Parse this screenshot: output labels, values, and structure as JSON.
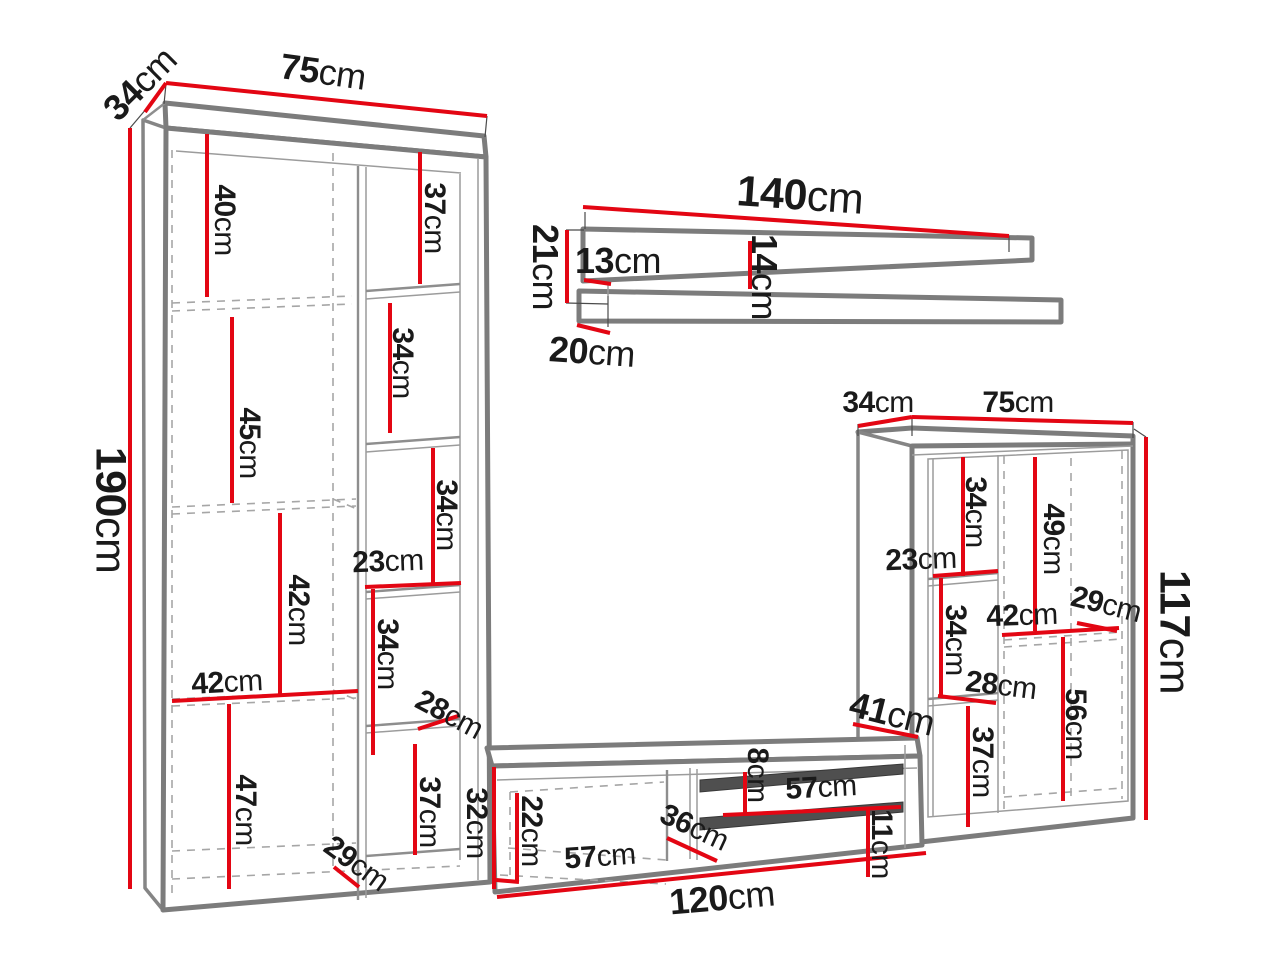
{
  "colors": {
    "dimension_red": "#e30613",
    "outline_gray": "#7c7c7c"
  },
  "left_cabinet": {
    "depth": "34cm",
    "width": "75cm",
    "height": "190cm",
    "left_column": {
      "compartment_1": "40cm",
      "compartment_2": "45cm",
      "compartment_3": "42cm",
      "inner_width": "42cm",
      "compartment_4": "47cm"
    },
    "right_column": {
      "compartment_1": "37cm",
      "compartment_2": "34cm",
      "compartment_3": "34cm",
      "inner_width": "23cm",
      "compartment_4": "34cm",
      "shelf_depth": "28cm",
      "compartment_5": "37cm",
      "base_height": "29cm"
    }
  },
  "wall_shelf": {
    "width": "140cm",
    "height": "21cm",
    "lip_height": "13cm",
    "mid_height": "14cm",
    "depth": "20cm"
  },
  "right_cabinet": {
    "depth": "34cm",
    "width": "75cm",
    "height": "117cm",
    "left_column": {
      "compartment_1": "34cm",
      "inner_width": "23cm",
      "compartment_2": "34cm",
      "shelf_width": "28cm",
      "compartment_3": "37cm"
    },
    "right_column": {
      "compartment_1": "49cm",
      "inner_width": "42cm",
      "shelf_depth": "29cm",
      "compartment_2": "56cm"
    }
  },
  "tv_stand": {
    "height": "32cm",
    "width": "120cm",
    "inner_height": "22cm",
    "door_width": "57cm",
    "door_diagonal": "36cm",
    "shelf_gap": "8cm",
    "niche_width": "57cm",
    "right_section_width": "41cm",
    "bottom_gap": "11cm"
  }
}
